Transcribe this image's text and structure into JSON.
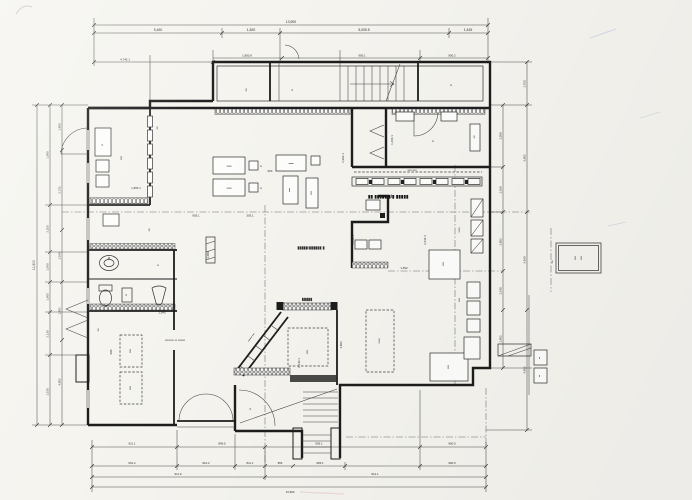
{
  "page": {
    "paper": "#f5f4ef",
    "ink": "#1d1d1d",
    "dim_ink": "#4a4a4a",
    "pencil_blue": "#b6c2d8",
    "pencil_pink": "#e4c3c6"
  },
  "dims": {
    "top_overall": "13,900",
    "top_row2": [
      "5,460",
      "1,820",
      "5,005.5",
      "1,615"
    ],
    "top_row3": [
      "4,745.1",
      "1,800.8",
      "900.1",
      "900.2"
    ],
    "bottom_row1": [
      "911.1",
      "899.5",
      "905.1",
      "900.5"
    ],
    "bottom_row2": [
      "901.2",
      "910.2",
      "811.1",
      "955",
      "905.1",
      "900.5"
    ],
    "bottom_row3": [
      "911.9",
      "912.1"
    ],
    "bottom_overall": "13,900",
    "left_overall": "11,900",
    "left_outer": [
      "1,980",
      "2,100",
      "1,960",
      "1,900",
      "2,130",
      "1,520"
    ],
    "left_inner": [
      "1,800",
      "2,732",
      "1,960",
      "1,802",
      "4,802"
    ],
    "right_inner": [
      "1,900",
      "1,360",
      "1,802",
      "1,240",
      "1,802"
    ],
    "right_outer": [
      "1,750",
      "3,802",
      "3,960",
      "4,802"
    ],
    "inner": [
      "1,460.1",
      "1,941.1",
      "2,636.1",
      "1,865.1",
      "303.1",
      "1,981.1",
      "900",
      "2,000",
      "1,592",
      "1,540",
      "600",
      "905.1",
      "2,130.1",
      "1,802"
    ]
  },
  "labels": {
    "bold_service": "▮▮ ▮▮▮▮▮  ▮/▮ ▮▮▮▮▮",
    "bold_row": "▮▮▮▮▮/▮▮▮▮▮▮ ▮",
    "bold_perron": "▮▮▮▮▮",
    "note_center": "▪▪▪▪▪▪▪▪▪ ▪▪ ▪▪▪▪▪▪▪",
    "ramp_note": "▪▪▪▪▪▪ ▪▪▪",
    "s2": "▪▪",
    "s3": "▪▪▪",
    "s4": "▪▪▪▪",
    "s5": "▪▪▪▪▪",
    "s6": "▪▪▪▪▪▪",
    "s8": "▪▪▪▪ ▪▪▪▪"
  }
}
